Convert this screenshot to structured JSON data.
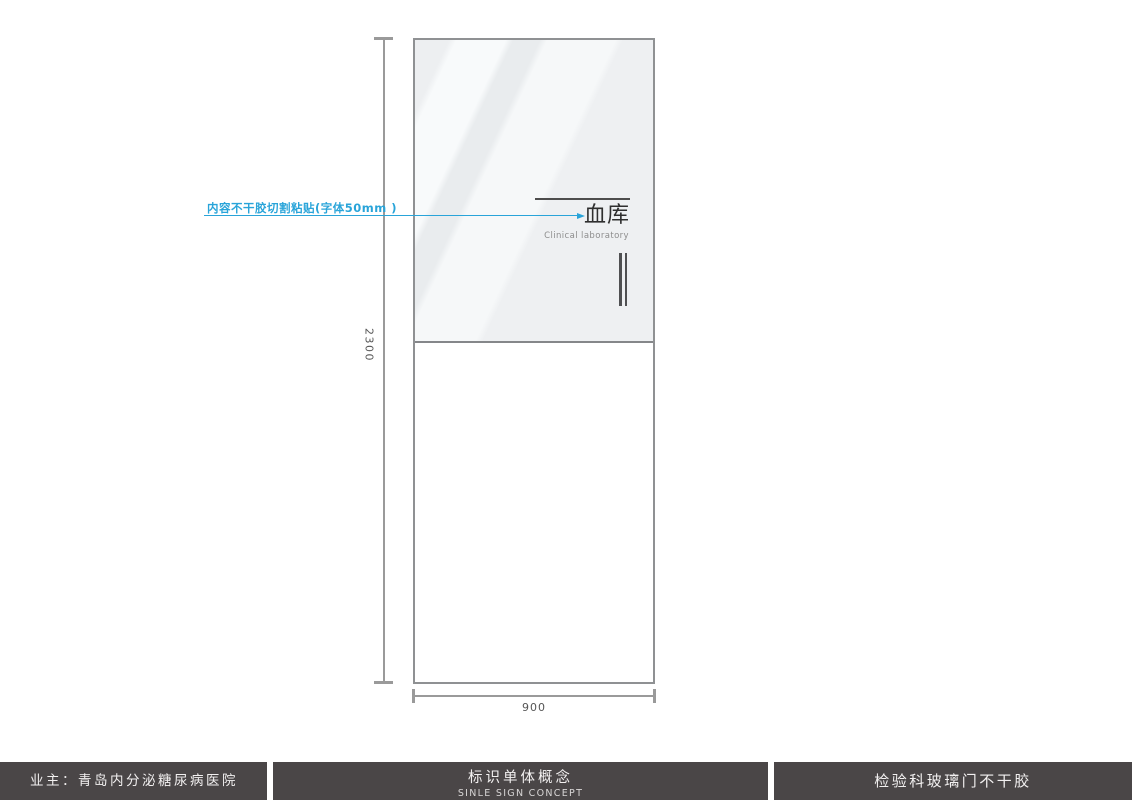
{
  "drawing": {
    "height_dim": "2300",
    "width_dim": "900"
  },
  "sign": {
    "title_cn": "血库",
    "subtitle_en": "Clinical laboratory"
  },
  "annotation": {
    "label": "内容不干胶切割粘贴(字体50mm )"
  },
  "footer": {
    "owner": "业主：青岛内分泌糖尿病医院",
    "center_title": "标识单体概念",
    "center_subtitle": "SINLE SIGN CONCEPT",
    "right_title": "检验科玻璃门不干胶"
  },
  "colors": {
    "accent_blue": "#29a4d9",
    "footer_bg": "#4a4647",
    "dim_line_gray": "#9a9a9a",
    "sign_text": "#2f2f2f"
  }
}
